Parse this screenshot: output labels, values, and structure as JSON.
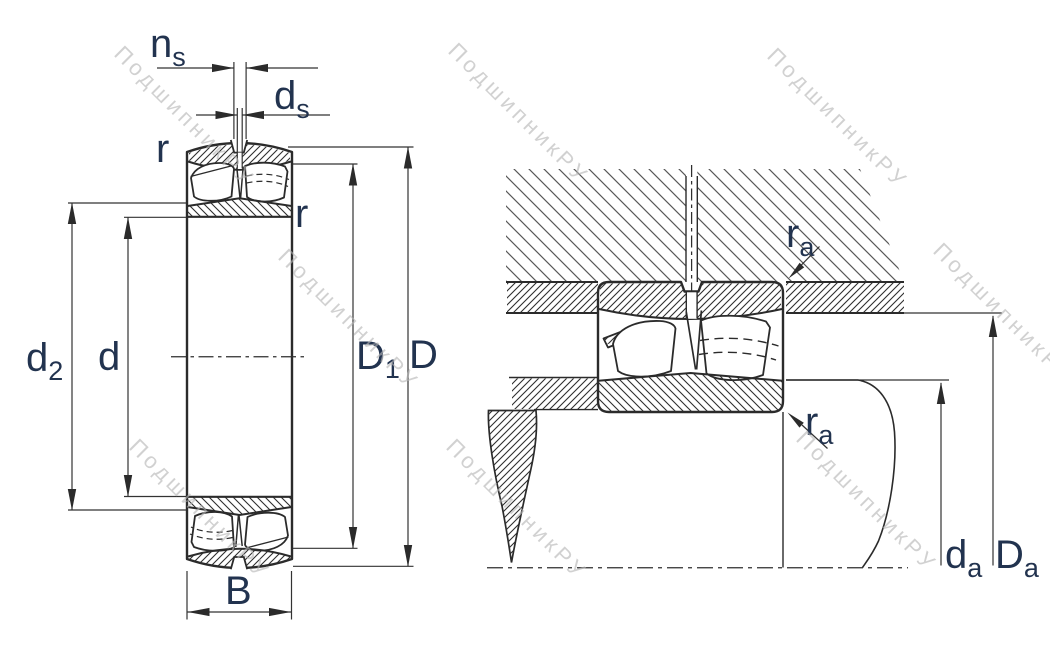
{
  "drawing": {
    "title": "spherical roller bearing dimension drawing",
    "views": [
      "bearing cross-section",
      "mounted bearing with shaft and housing abutments"
    ]
  },
  "watermark": {
    "text": "ПодшипникРУ"
  },
  "left_view": {
    "labels": {
      "ns_base": "n",
      "ns_sub": "s",
      "ds_base": "d",
      "ds_sub": "s",
      "r_top": "r",
      "r_side": "r",
      "d2_base": "d",
      "d2_sub": "2",
      "d": "d",
      "D1_base": "D",
      "D1_sub": "1",
      "D": "D",
      "B": "B"
    }
  },
  "right_view": {
    "labels": {
      "ra_top_base": "r",
      "ra_top_sub": "a",
      "ra_bottom_base": "r",
      "ra_bottom_sub": "a",
      "da_base": "d",
      "da_sub": "a",
      "Da_base": "D",
      "Da_sub": "a"
    }
  },
  "colors": {
    "label": "#22334f",
    "line": "#2b2b2b",
    "ring_hatch": "#2e2e2e",
    "housing_hatch": "#585858",
    "watermark": "#b5b5b5",
    "background": "#ffffff"
  }
}
